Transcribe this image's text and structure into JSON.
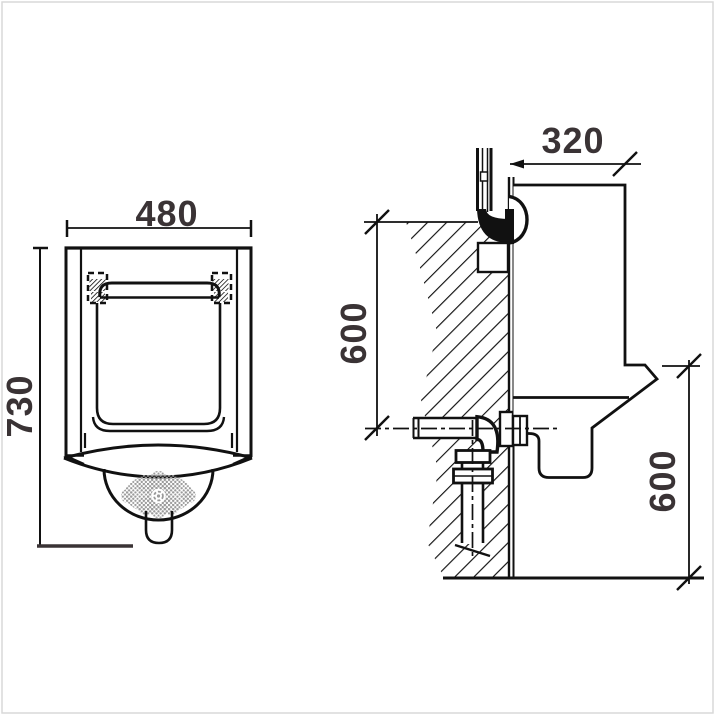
{
  "drawing": {
    "views": {
      "front": {
        "width_label": "480",
        "height_label": "730"
      },
      "side": {
        "depth_label": "320",
        "upper_height_label": "600",
        "lower_height_label": "600"
      }
    },
    "colors": {
      "line": "#111111",
      "dimension_text": "#3a3335",
      "drain_flower_gray": "#9a9a9a",
      "frame": "#d9d9d9",
      "background": "#ffffff"
    }
  }
}
